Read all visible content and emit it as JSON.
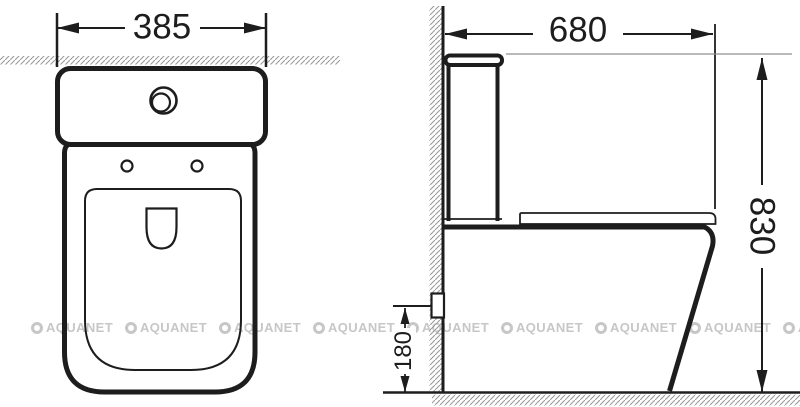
{
  "drawing": {
    "front_view": {
      "width_dim": "385"
    },
    "side_view": {
      "depth_dim": "680",
      "height_dim": "830",
      "outlet_height_dim": "180"
    }
  },
  "watermark": {
    "text": "AQUANET"
  },
  "colors": {
    "line": "#1d1d1d",
    "hatch": "#9b9b9b",
    "watermark": "#c7c7c7",
    "background": "#ffffff"
  }
}
